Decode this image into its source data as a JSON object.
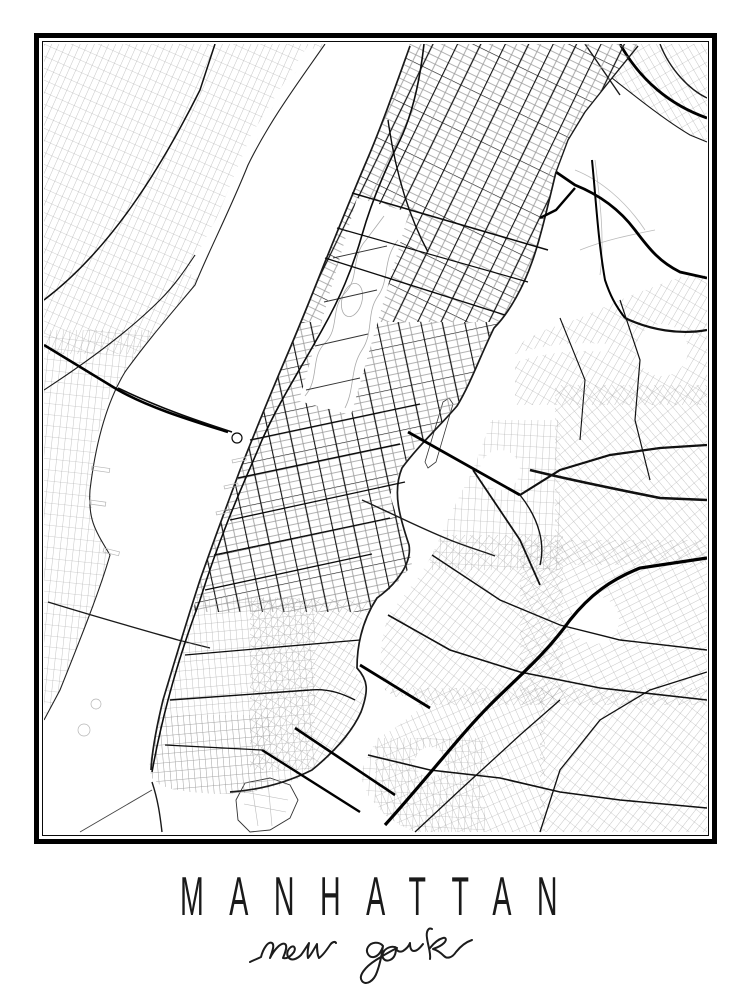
{
  "poster": {
    "title": "MANHATTAN",
    "subtitle": "new york",
    "colors": {
      "background": "#ffffff",
      "frame": "#000000",
      "road_major": "#111111",
      "road_minor": "#9a9a9a",
      "water": "#ffffff"
    },
    "map_features": [
      "manhattan-street-grid",
      "central-park",
      "hudson-river",
      "east-river",
      "harlem-river",
      "new-jersey-shore",
      "brooklyn-grid",
      "queens-grid",
      "bronx-grid",
      "randalls-island",
      "roosevelt-island",
      "governors-island",
      "queensboro-bridge",
      "williamsburg-bridge",
      "manhattan-bridge",
      "brooklyn-bridge",
      "lincoln-tunnel",
      "holland-tunnel"
    ]
  }
}
